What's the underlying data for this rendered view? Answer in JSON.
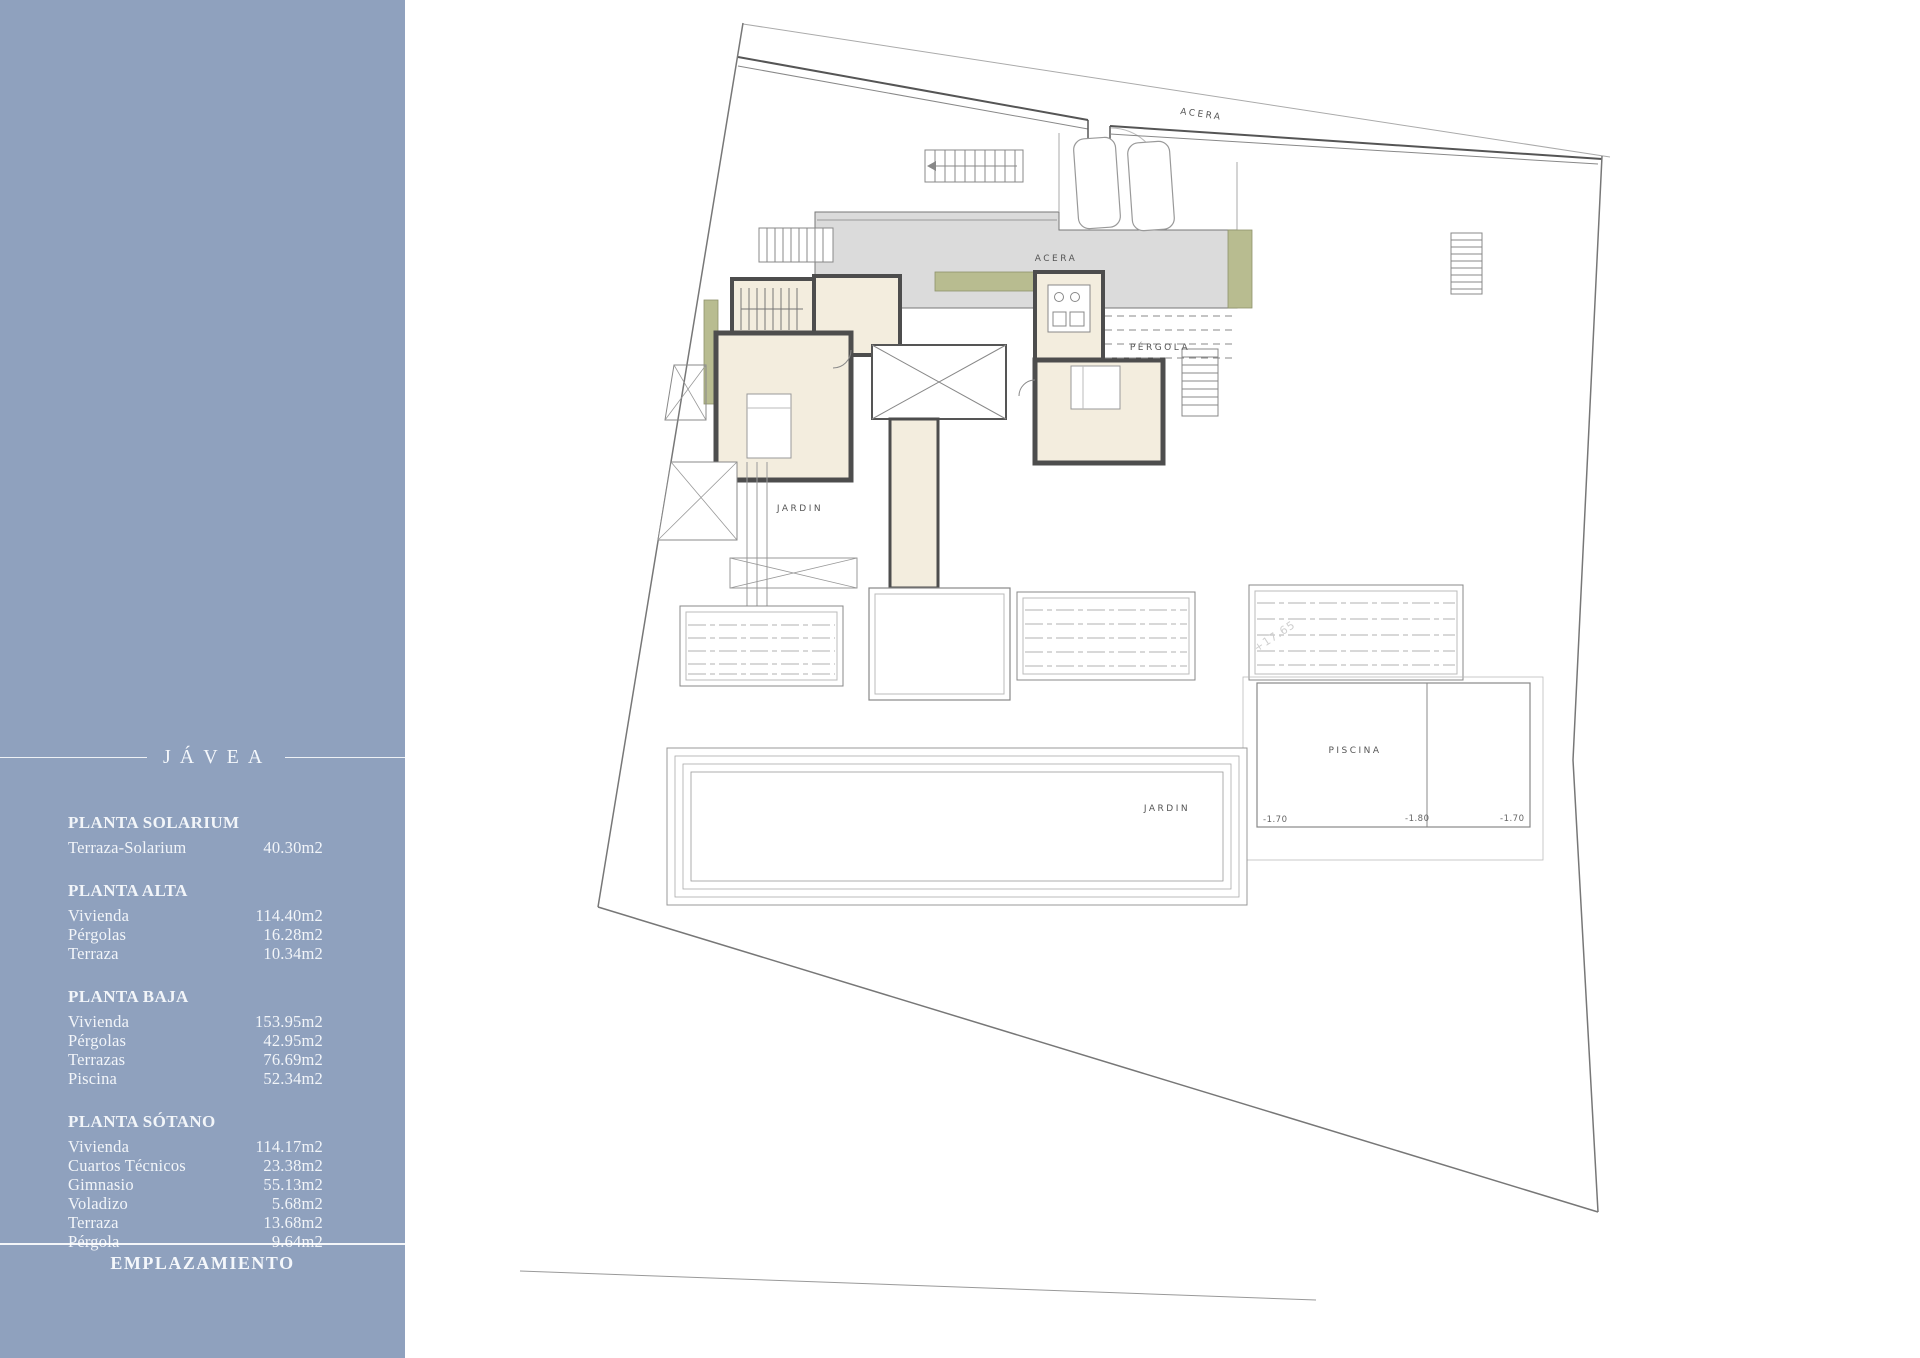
{
  "sidebar": {
    "bg_color": "#8FA1BE",
    "title": "JÁVEA",
    "sections": [
      {
        "heading": "PLANTA SOLARIUM",
        "rows": [
          {
            "label": "Terraza-Solarium",
            "value": "40.30m2"
          }
        ]
      },
      {
        "heading": "PLANTA ALTA",
        "rows": [
          {
            "label": "Vivienda",
            "value": "114.40m2"
          },
          {
            "label": "Pérgolas",
            "value": "16.28m2"
          },
          {
            "label": "Terraza",
            "value": "10.34m2"
          }
        ]
      },
      {
        "heading": "PLANTA BAJA",
        "rows": [
          {
            "label": "Vivienda",
            "value": "153.95m2"
          },
          {
            "label": "Pérgolas",
            "value": "42.95m2"
          },
          {
            "label": "Terrazas",
            "value": "76.69m2"
          },
          {
            "label": "Piscina",
            "value": "52.34m2"
          }
        ]
      },
      {
        "heading": "PLANTA SÓTANO",
        "rows": [
          {
            "label": "Vivienda",
            "value": "114.17m2"
          },
          {
            "label": "Cuartos Técnicos",
            "value": "23.38m2"
          },
          {
            "label": "Gimnasio",
            "value": "55.13m2"
          },
          {
            "label": "Voladizo",
            "value": "5.68m2"
          },
          {
            "label": "Terraza",
            "value": "13.68m2"
          },
          {
            "label": "Pérgola",
            "value": "9.64m2"
          }
        ]
      }
    ],
    "footer_title": "EMPLAZAMIENTO"
  },
  "plan": {
    "labels": {
      "acera_top": "ACERA",
      "acera_terrace": "ACERA",
      "pergola": "PÉRGOLA",
      "jardin_left": "JARDIN",
      "jardin_bottom": "JARDIN",
      "piscina": "PISCINA",
      "level_left": "-1.70",
      "level_mid": "-1.80",
      "level_right": "-1.70",
      "elevation_note": "+17.65"
    },
    "colors": {
      "wall": "#4d4d4d",
      "room": "#F3EDDE",
      "paving": "#DBDBDB",
      "planting": "#B8BC90",
      "line": "#888888"
    }
  }
}
